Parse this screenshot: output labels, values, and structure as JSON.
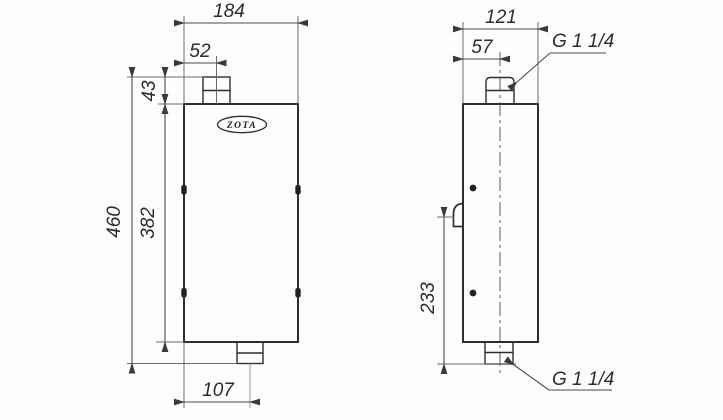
{
  "drawing": {
    "logo": "ZOTA",
    "colors": {
      "line": "#2e2e2e",
      "dimension": "#4c4c4c",
      "background": "#fdfdfd"
    },
    "front_view": {
      "width_total": "184",
      "top_pipe_offset": "52",
      "top_pipe_height": "43",
      "height_total": "460",
      "body_height": "382",
      "bottom_pipe_offset": "107"
    },
    "side_view": {
      "width_total": "121",
      "top_pipe_offset": "57",
      "bracket_to_bottom": "233",
      "top_connection_thread": "G 1 1/4",
      "bottom_connection_thread": "G 1 1/4"
    }
  }
}
